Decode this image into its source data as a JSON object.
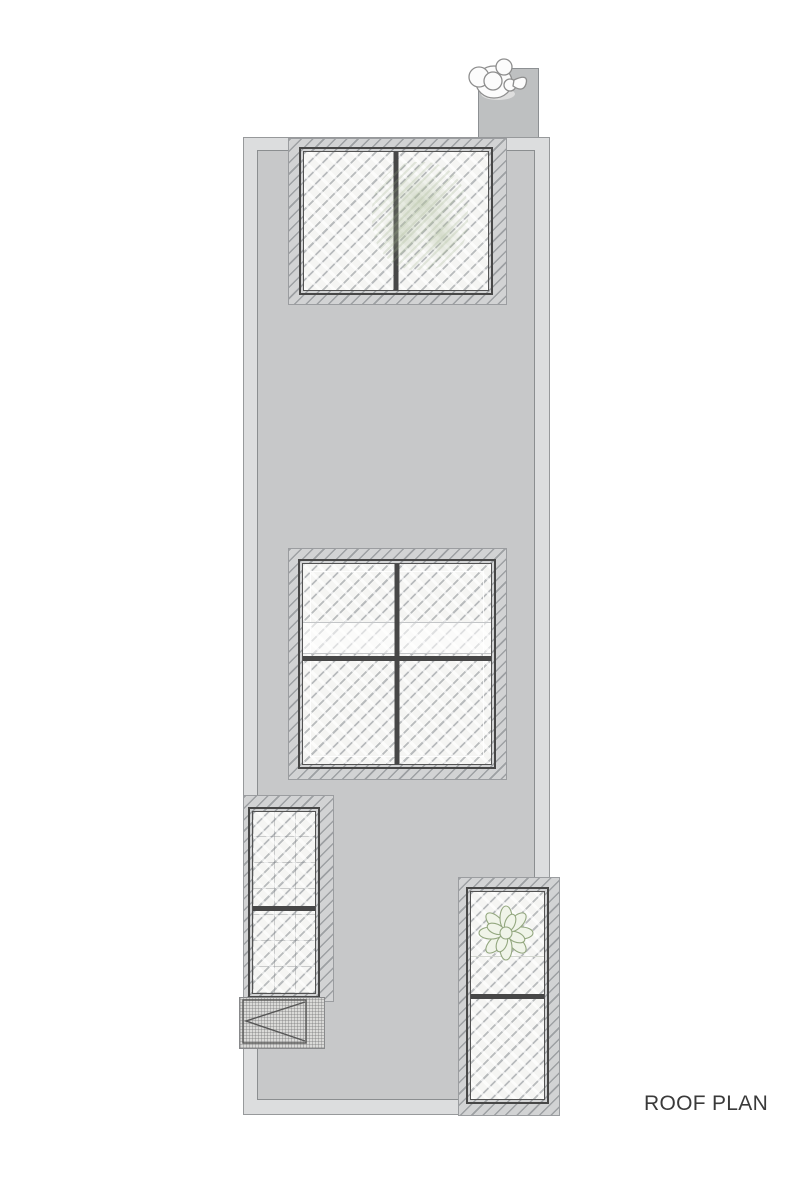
{
  "title_label": "ROOF PLAN",
  "colors": {
    "bg": "#ffffff",
    "roof_outer": "#dcddde",
    "roof_inner": "#c7c8c9",
    "vent": "#bec0c1",
    "curb": "#d2d3d4",
    "glass": "#f5f5f3",
    "frame": "#474747",
    "plant_stroke": "#93a77f",
    "plant_fill": "#f0f4e9",
    "label": "#3a3a3a"
  }
}
